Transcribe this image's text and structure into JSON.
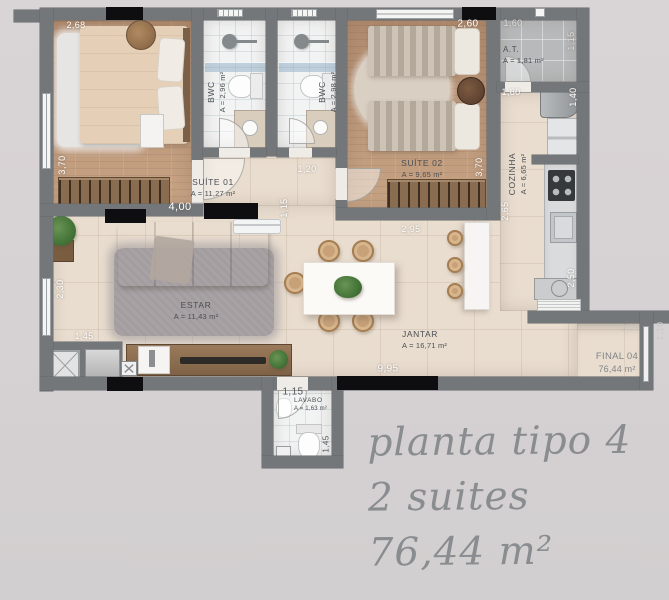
{
  "plan": {
    "rooms": {
      "suite01": {
        "name": "SUÍTE 01",
        "area": "A = 11,27 m²"
      },
      "suite02": {
        "name": "SUÍTE 02",
        "area": "A = 9,65 m²"
      },
      "bwc1": {
        "name": "BWC",
        "area": "A = 2,96 m²"
      },
      "bwc2": {
        "name": "BWC",
        "area": "A = 2,98 m²"
      },
      "at": {
        "name": "A.T.",
        "area": "A = 1,81 m²"
      },
      "cozinha": {
        "name": "COZINHA",
        "area": "A = 6,65 m²"
      },
      "estar": {
        "name": "ESTAR",
        "area": "A = 11,43 m²"
      },
      "jantar": {
        "name": "JANTAR",
        "area": "A = 16,71 m²"
      },
      "lavabo": {
        "name": "LAVABO",
        "area": "A = 1,63 m²"
      },
      "final": {
        "name": "FINAL 04",
        "area": "76,44 m²"
      }
    },
    "dimensions": {
      "suite01_top": "2,68",
      "suite01_left": "3,70",
      "suite01_bottom": "4,00",
      "hall_width": "1,20",
      "hall_height": "1,15",
      "suite02_top": "2,60",
      "suite02_right": "3,70",
      "suite02_bottom": "2,95",
      "at_top": "1,60",
      "at_right": "1,15",
      "cozinha_top": "1,60",
      "cozinha_right_upper": "1,40",
      "cozinha_left": "2,65",
      "cozinha_right_lower": "2,50",
      "estar_left": "2,30",
      "estar_bottom": "1,45",
      "jantar_bottom": "9,95",
      "lavabo_top": "1,15",
      "lavabo_right": "1,45",
      "balcony_top": "2,25",
      "balcony_right": "1,10"
    }
  },
  "caption": {
    "line1": "planta tipo 4",
    "line2": "2 suites",
    "line3": "76,44  m²"
  }
}
